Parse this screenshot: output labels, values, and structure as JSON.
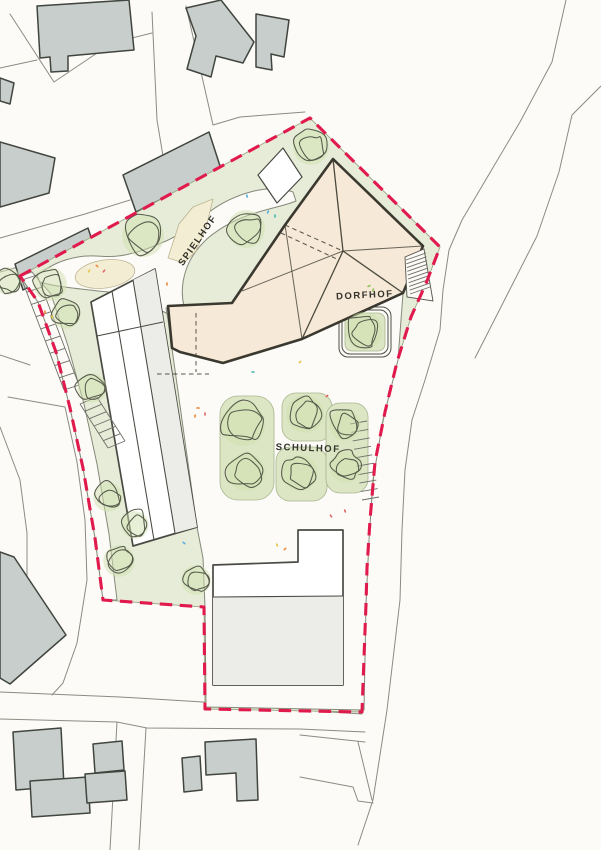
{
  "labels": {
    "spielhof": "SPIELHOF",
    "dorfhof": "DORFHOF",
    "schulhof": "SCHULHOF"
  },
  "palette": {
    "paper": "#fcfbf7",
    "line_thin": "#8b8b83",
    "building_gray": "#c7cecb",
    "building_stroke": "#41453f",
    "green": "#e6ecd8",
    "green_patch": "#dce6c4",
    "tree_fill": "#cfe0ae",
    "tree_stroke": "#565a4b",
    "sand": "#f3edd3",
    "roof": "#f6e9d7",
    "roof_line": "#3a382f",
    "red": "#e11a4e",
    "text": "#33322b",
    "hatch": "#6f6f68",
    "path_line": "#85897a",
    "confetti": {
      "orange": "#ef8a3c",
      "red": "#e06666",
      "yellow": "#e8c64a",
      "blue": "#5aaede",
      "teal": "#45b8b0",
      "green": "#8fbe5a"
    }
  },
  "site": {
    "trees": [
      {
        "x": 311,
        "y": 147,
        "r": 17
      },
      {
        "x": 143,
        "y": 236,
        "r": 20
      },
      {
        "x": 246,
        "y": 229,
        "r": 18
      },
      {
        "x": 8,
        "y": 281,
        "r": 13
      },
      {
        "x": 50,
        "y": 284,
        "r": 16
      },
      {
        "x": 66,
        "y": 314,
        "r": 14
      },
      {
        "x": 92,
        "y": 388,
        "r": 14
      },
      {
        "x": 108,
        "y": 497,
        "r": 14
      },
      {
        "x": 135,
        "y": 525,
        "r": 13
      },
      {
        "x": 119,
        "y": 561,
        "r": 15
      },
      {
        "x": 196,
        "y": 580,
        "r": 14
      },
      {
        "x": 243,
        "y": 424,
        "r": 21
      },
      {
        "x": 246,
        "y": 472,
        "r": 18
      },
      {
        "x": 305,
        "y": 414,
        "r": 18
      },
      {
        "x": 300,
        "y": 473,
        "r": 17
      },
      {
        "x": 345,
        "y": 425,
        "r": 15
      },
      {
        "x": 346,
        "y": 467,
        "r": 15
      },
      {
        "x": 364,
        "y": 331,
        "r": 18
      }
    ],
    "parking": [
      {
        "x1": 22,
        "y1": 280,
        "x2": 64,
        "y2": 390,
        "ox": 15,
        "oy": -5,
        "n": 9,
        "rails": true
      },
      {
        "x1": 80,
        "y1": 404,
        "x2": 108,
        "y2": 448,
        "ox": 17,
        "oy": -7,
        "n": 6,
        "rails": true
      },
      {
        "x1": 350,
        "y1": 424,
        "x2": 362,
        "y2": 500,
        "ox": 17,
        "oy": -3,
        "n": 9,
        "rails": false
      },
      {
        "x1": 406,
        "y1": 260,
        "x2": 410,
        "y2": 294,
        "ox": 20,
        "oy": -7,
        "n": 9,
        "rails": false
      }
    ],
    "confetti": [
      {
        "x": 268,
        "y": 212,
        "c": "blue"
      },
      {
        "x": 275,
        "y": 216,
        "c": "teal"
      },
      {
        "x": 247,
        "y": 196,
        "c": "blue"
      },
      {
        "x": 97,
        "y": 266,
        "c": "orange"
      },
      {
        "x": 104,
        "y": 271,
        "c": "red"
      },
      {
        "x": 89,
        "y": 271,
        "c": "yellow"
      },
      {
        "x": 45,
        "y": 312,
        "c": "orange"
      },
      {
        "x": 52,
        "y": 317,
        "c": "yellow"
      },
      {
        "x": 167,
        "y": 284,
        "c": "orange"
      },
      {
        "x": 198,
        "y": 408,
        "c": "orange"
      },
      {
        "x": 205,
        "y": 414,
        "c": "red"
      },
      {
        "x": 195,
        "y": 416,
        "c": "orange"
      },
      {
        "x": 277,
        "y": 545,
        "c": "yellow"
      },
      {
        "x": 285,
        "y": 549,
        "c": "orange"
      },
      {
        "x": 331,
        "y": 516,
        "c": "red"
      },
      {
        "x": 345,
        "y": 511,
        "c": "red"
      },
      {
        "x": 184,
        "y": 543,
        "c": "blue"
      },
      {
        "x": 369,
        "y": 286,
        "c": "green"
      },
      {
        "x": 373,
        "y": 290,
        "c": "green"
      },
      {
        "x": 300,
        "y": 362,
        "c": "yellow"
      },
      {
        "x": 327,
        "y": 396,
        "c": "red"
      },
      {
        "x": 253,
        "y": 372,
        "c": "teal"
      }
    ]
  }
}
